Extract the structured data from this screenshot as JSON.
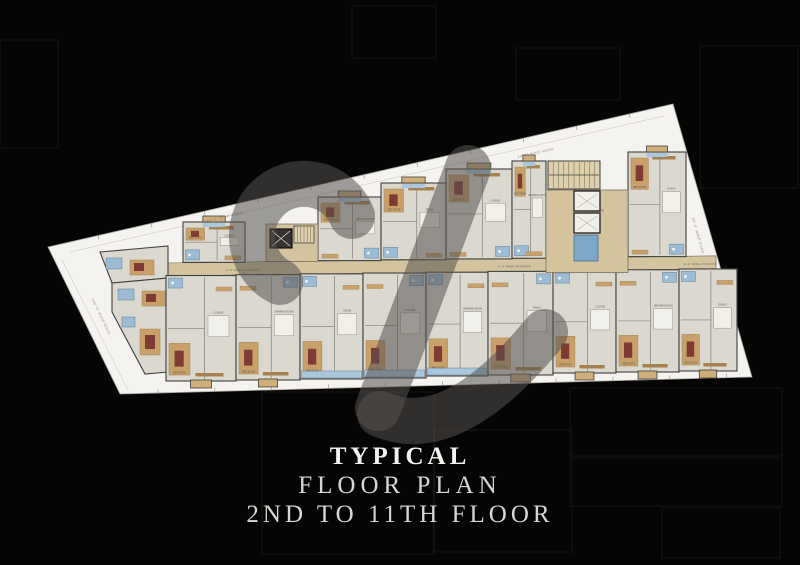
{
  "title": {
    "line1": "TYPICAL",
    "line2": "FLOOR PLAN",
    "line3": "2ND TO 11TH FLOOR"
  },
  "colors": {
    "bg": "#060505",
    "bg_line": "rgba(150,105,75,0.14)",
    "site": "#f4f3ef",
    "site_edge": "#a8a49c",
    "setback_line": "#c6c2b9",
    "corridor": "#d3c49e",
    "corridor_edge": "#6d6456",
    "floor": "#dbd8d0",
    "wall": "#413f3b",
    "partition": "#807c74",
    "tan": "#c7a06a",
    "tan_dark": "#a8824e",
    "red": "#7e3b33",
    "bath": "#9bbcd4",
    "bath_edge": "#5f7f96",
    "glaze": "#a9c7dc",
    "balcony": "#cfae7a",
    "rug": "#f1efe9",
    "tank": "#7fa8c8",
    "lift_dark": "#35332f",
    "stair": "#ddd0ab",
    "tick": "#8f8b80",
    "road_text": "#8a8578",
    "room_text": "#5f5a50",
    "watermark": "#55524e"
  },
  "site": {
    "polygon": [
      [
        48,
        247
      ],
      [
        673,
        104
      ],
      [
        752,
        377
      ],
      [
        120,
        394
      ]
    ]
  },
  "corridor": {
    "x1": 166,
    "x2": 716,
    "y_at_x1": 263,
    "slope": -0.013,
    "height": 13,
    "label": "6'-0\" WIDE PASSAGE",
    "label_x": [
      226,
      498,
      684
    ]
  },
  "road_labels": [
    {
      "text": "40'-0\" WIDE ROAD",
      "x": 225,
      "y": 218,
      "rot": -12.9
    },
    {
      "text": "40'-0\" WIDE ROAD",
      "x": 536,
      "y": 154,
      "rot": -12.9
    },
    {
      "text": "100'-0\" WIDE ROAD",
      "x": 100,
      "y": 317,
      "rot": 64
    },
    {
      "text": "80'-0\" WIDE ROAD",
      "x": 697,
      "y": 236,
      "rot": 74
    }
  ],
  "lift_lobby_label": "LIFT LOBBY",
  "room_labels": {
    "bed": "BED ROOM",
    "others": [
      "LOUNGE",
      "DRAWING ROOM",
      "DINING"
    ]
  },
  "units_upper": [
    {
      "x": 183,
      "w": 62,
      "top": 222
    },
    {
      "x": 318,
      "w": 63,
      "top": 197
    },
    {
      "x": 381,
      "w": 65,
      "top": 183
    },
    {
      "x": 446,
      "w": 66,
      "top": 169
    },
    {
      "x": 512,
      "w": 34,
      "top": 161
    },
    {
      "x": 628,
      "w": 58,
      "top": 152
    }
  ],
  "units_lower": [
    {
      "x": 166,
      "w": 70,
      "bottom": 381
    },
    {
      "x": 236,
      "w": 64,
      "bottom": 380
    },
    {
      "x": 300,
      "w": 63,
      "bottom": 379,
      "blue_edge": true
    },
    {
      "x": 363,
      "w": 63,
      "bottom": 378,
      "blue_edge": true
    },
    {
      "x": 426,
      "w": 62,
      "bottom": 376,
      "blue_edge": true
    },
    {
      "x": 488,
      "w": 65,
      "bottom": 375
    },
    {
      "x": 553,
      "w": 63,
      "bottom": 373
    },
    {
      "x": 616,
      "w": 63,
      "bottom": 372
    },
    {
      "x": 679,
      "w": 58,
      "bottom": 371
    }
  ],
  "left_cluster": [
    {
      "points": [
        [
          100,
          252
        ],
        [
          168,
          246
        ],
        [
          168,
          278
        ],
        [
          112,
          283
        ]
      ]
    },
    {
      "points": [
        [
          112,
          283
        ],
        [
          168,
          278
        ],
        [
          168,
          372
        ],
        [
          145,
          374
        ],
        [
          112,
          312
        ]
      ]
    }
  ],
  "core1": {
    "zone": [
      266,
      224,
      52
    ],
    "lift": [
      270,
      229,
      22,
      19
    ],
    "stair": [
      294,
      226,
      20,
      17
    ]
  },
  "core2": {
    "zone_x": 546,
    "zone_w": 82,
    "stair": [
      548,
      161,
      52,
      28
    ],
    "lifts": [
      [
        574,
        191,
        26,
        20
      ],
      [
        574,
        213,
        26,
        20
      ]
    ],
    "tank": [
      574,
      235,
      24,
      26
    ],
    "lobby_label_pos": [
      596,
      212
    ]
  },
  "watermark": {
    "opacity": 0.55,
    "width": 46,
    "strokes": [
      "M 280 282 A 52 52 0 1 1 352 216",
      "M 468 168 L 378 408",
      "M 380 414 Q 452 446 545 332"
    ]
  },
  "bg_rects": [
    [
      516,
      48,
      104,
      52
    ],
    [
      700,
      46,
      98,
      142
    ],
    [
      570,
      388,
      212,
      68
    ],
    [
      570,
      458,
      212,
      48
    ],
    [
      662,
      508,
      118,
      50
    ],
    [
      262,
      392,
      172,
      162
    ],
    [
      434,
      430,
      138,
      122
    ],
    [
      352,
      6,
      84,
      52
    ],
    [
      0,
      40,
      58,
      108
    ]
  ]
}
